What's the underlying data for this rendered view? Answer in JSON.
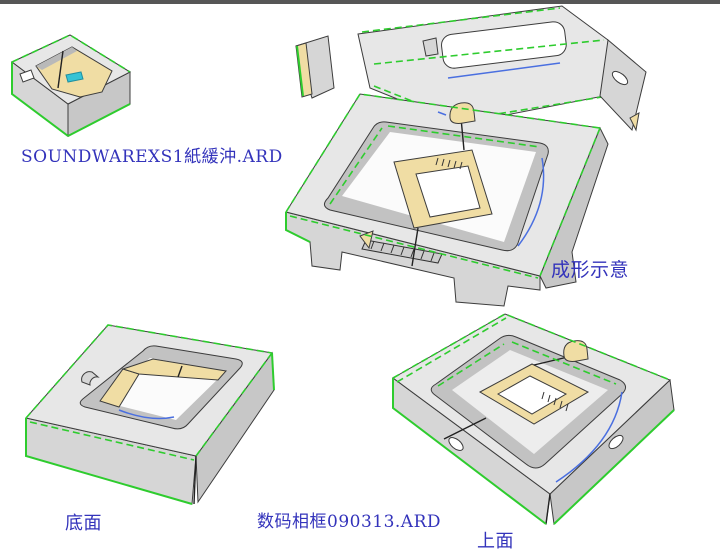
{
  "window": {
    "background": "#ffffff",
    "top_edge_note": "thin dark strip along top of drawing area"
  },
  "views": [
    {
      "id": "thumbnail",
      "caption": "SOUNDWAREXS1紙緩沖.ARD",
      "content": "small folded paper-buffer box, isometric view"
    },
    {
      "id": "forming",
      "caption": "成形示意",
      "content": "large tray with lid flap partially folded, handle cutout"
    },
    {
      "id": "bottom",
      "caption": "底面",
      "content": "tray seen from bottom face with rectangular opening"
    },
    {
      "id": "top",
      "caption": "上面",
      "content": "tray seen from top face with recess and platform"
    }
  ],
  "file_label": "数码相框090313.ARD",
  "colors": {
    "label_text": "#3333bb",
    "top_bar": "#565656",
    "board_face": "#e7e7e7",
    "board_side": "#d6d6d6",
    "board_side_dark": "#c7c7c7",
    "board_wall": "#c2c2c2",
    "inner_tan": "#f0dda4",
    "crease_green": "#2ecc2e",
    "cut_blue": "#4a6fe0",
    "accent_cyan": "#35c3d5",
    "outline": "#3c3c3c"
  }
}
